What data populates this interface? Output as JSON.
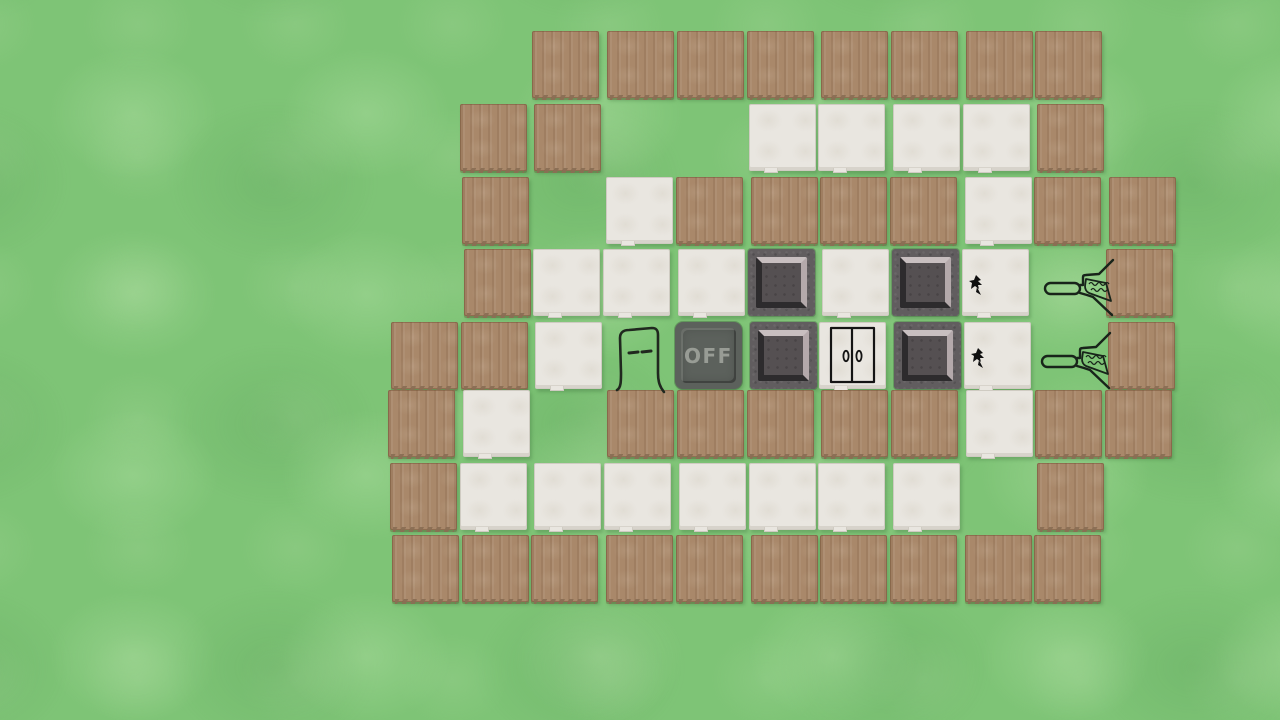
{
  "board": {
    "origin": {
      "x": 390,
      "y": 33
    },
    "pitch_x": 71.72,
    "pitch_y": 71.75,
    "tile_size": 67,
    "rows": 8,
    "cols": 11,
    "legend": {
      ".": "grass",
      "W": "wood",
      "F": "floor",
      "P": "plate",
      "B": "off_button"
    },
    "map": [
      "..WWWWWWWW.",
      ".WW..FFFFW.",
      ".W.FWWWWFWW",
      ".WFFFPFPF.W",
      "WWF.BPFPF.W",
      "WF.WWWWWFWW",
      "WFFFFFFF.W.",
      "WWWWWWWWWW."
    ]
  },
  "sprites": [
    {
      "type": "player",
      "row": 4,
      "col": 3
    },
    {
      "type": "door",
      "row": 4,
      "col": 6
    },
    {
      "type": "bug",
      "row": 3,
      "col": 8
    },
    {
      "type": "bug",
      "row": 4,
      "col": 8
    },
    {
      "type": "broom",
      "row": 3,
      "col": 9
    },
    {
      "type": "broom",
      "row": 4,
      "col": 9
    }
  ],
  "labels": {
    "off_button": "OFF"
  },
  "colors": {
    "grass": "#7ec476",
    "grass_light": "#8ed489",
    "grass_dark": "#72bc6a",
    "wood": "#a9886a",
    "wood_edge": "#8a6e54",
    "floor": "#e9e6e0",
    "stone": "#615d5f",
    "stone_inner": "#555052",
    "bevel_light": "#c8bfc0",
    "bevel_light2": "#b4a9ab",
    "bevel_dark": "#2d2b2d",
    "off_bg": "#5c615c",
    "off_text": "#989c95",
    "ink": "#20281f"
  }
}
